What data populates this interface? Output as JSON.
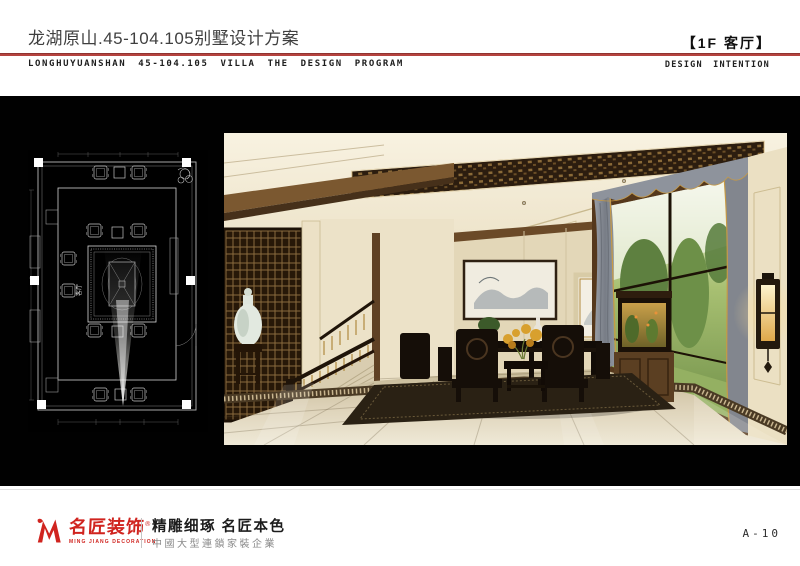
{
  "page": {
    "width": 800,
    "height": 566,
    "background": "#ffffff"
  },
  "header": {
    "title_cn": "龙湖原山.45-104.105别墅设计方案",
    "title_en": "LONGHUYUANSHAN 45-104.105 VILLA THE DESIGN PROGRAM",
    "room_tag": "【1F 客厅】",
    "design_intention": "DESIGN INTENTION",
    "rule_color": "#b5433f"
  },
  "plan": {
    "room_label": "客厅",
    "background": "#000000",
    "line_color": "#c8c8c8"
  },
  "rendering": {
    "palette": {
      "ceiling": "#f2ebd8",
      "wood_trim": "#6b4a28",
      "lattice": "#2c1d0f",
      "wall": "#e3d7b8",
      "floor": "#d9cfb4",
      "curtain": "#8b8f96",
      "greenery": "#7c9a50",
      "lamp_glow": "#edc06a",
      "furniture": "#150e08"
    }
  },
  "footer": {
    "logo_text": "名匠装饰",
    "registered_mark": "®",
    "logo_subtext": "MING JIANG DECORATION",
    "slogan": "精雕细琢 名匠本色",
    "company_line": "中國大型連鎖家裝企業",
    "page_number": "A-10",
    "logo_color": "#d0241f"
  }
}
